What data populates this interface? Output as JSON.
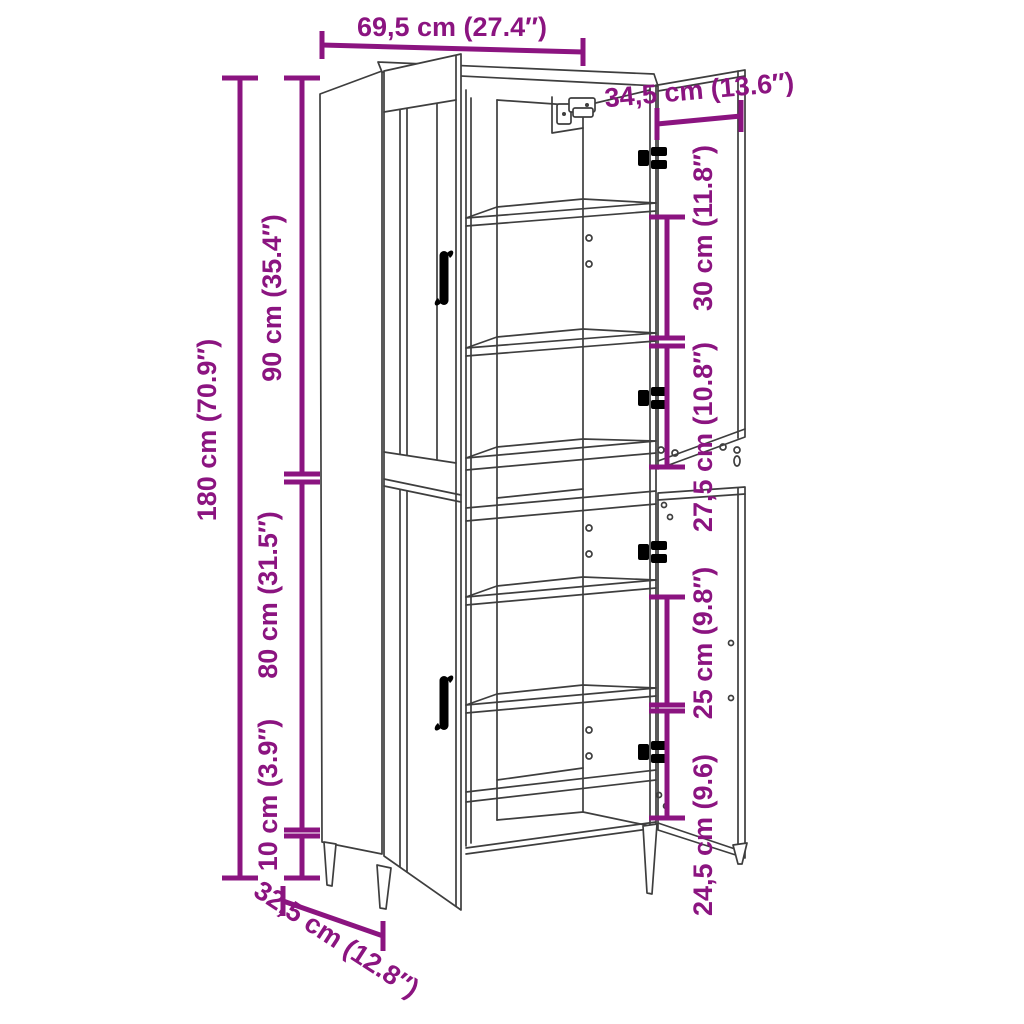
{
  "drawing": {
    "background": "#ffffff",
    "dimension_color": "#8B1480",
    "line_color": "#3E3E3E",
    "labels": {
      "width_top": "69,5 cm (27.4″)",
      "door_width": "34,5 cm (13.6″)",
      "height_total": "180 cm (70.9″)",
      "height_upper": "90 cm (35.4″)",
      "height_lower": "80 cm (31.5″)",
      "height_legs": "10 cm (3.9″)",
      "upper_compartment_1": "30 cm (11.8″)",
      "upper_compartment_2": "27,5 cm (10.8″)",
      "lower_compartment_1": "25 cm (9.8″)",
      "lower_compartment_2": "24,5 cm (9.6)",
      "depth": "32,5 cm (12.8″)"
    }
  }
}
